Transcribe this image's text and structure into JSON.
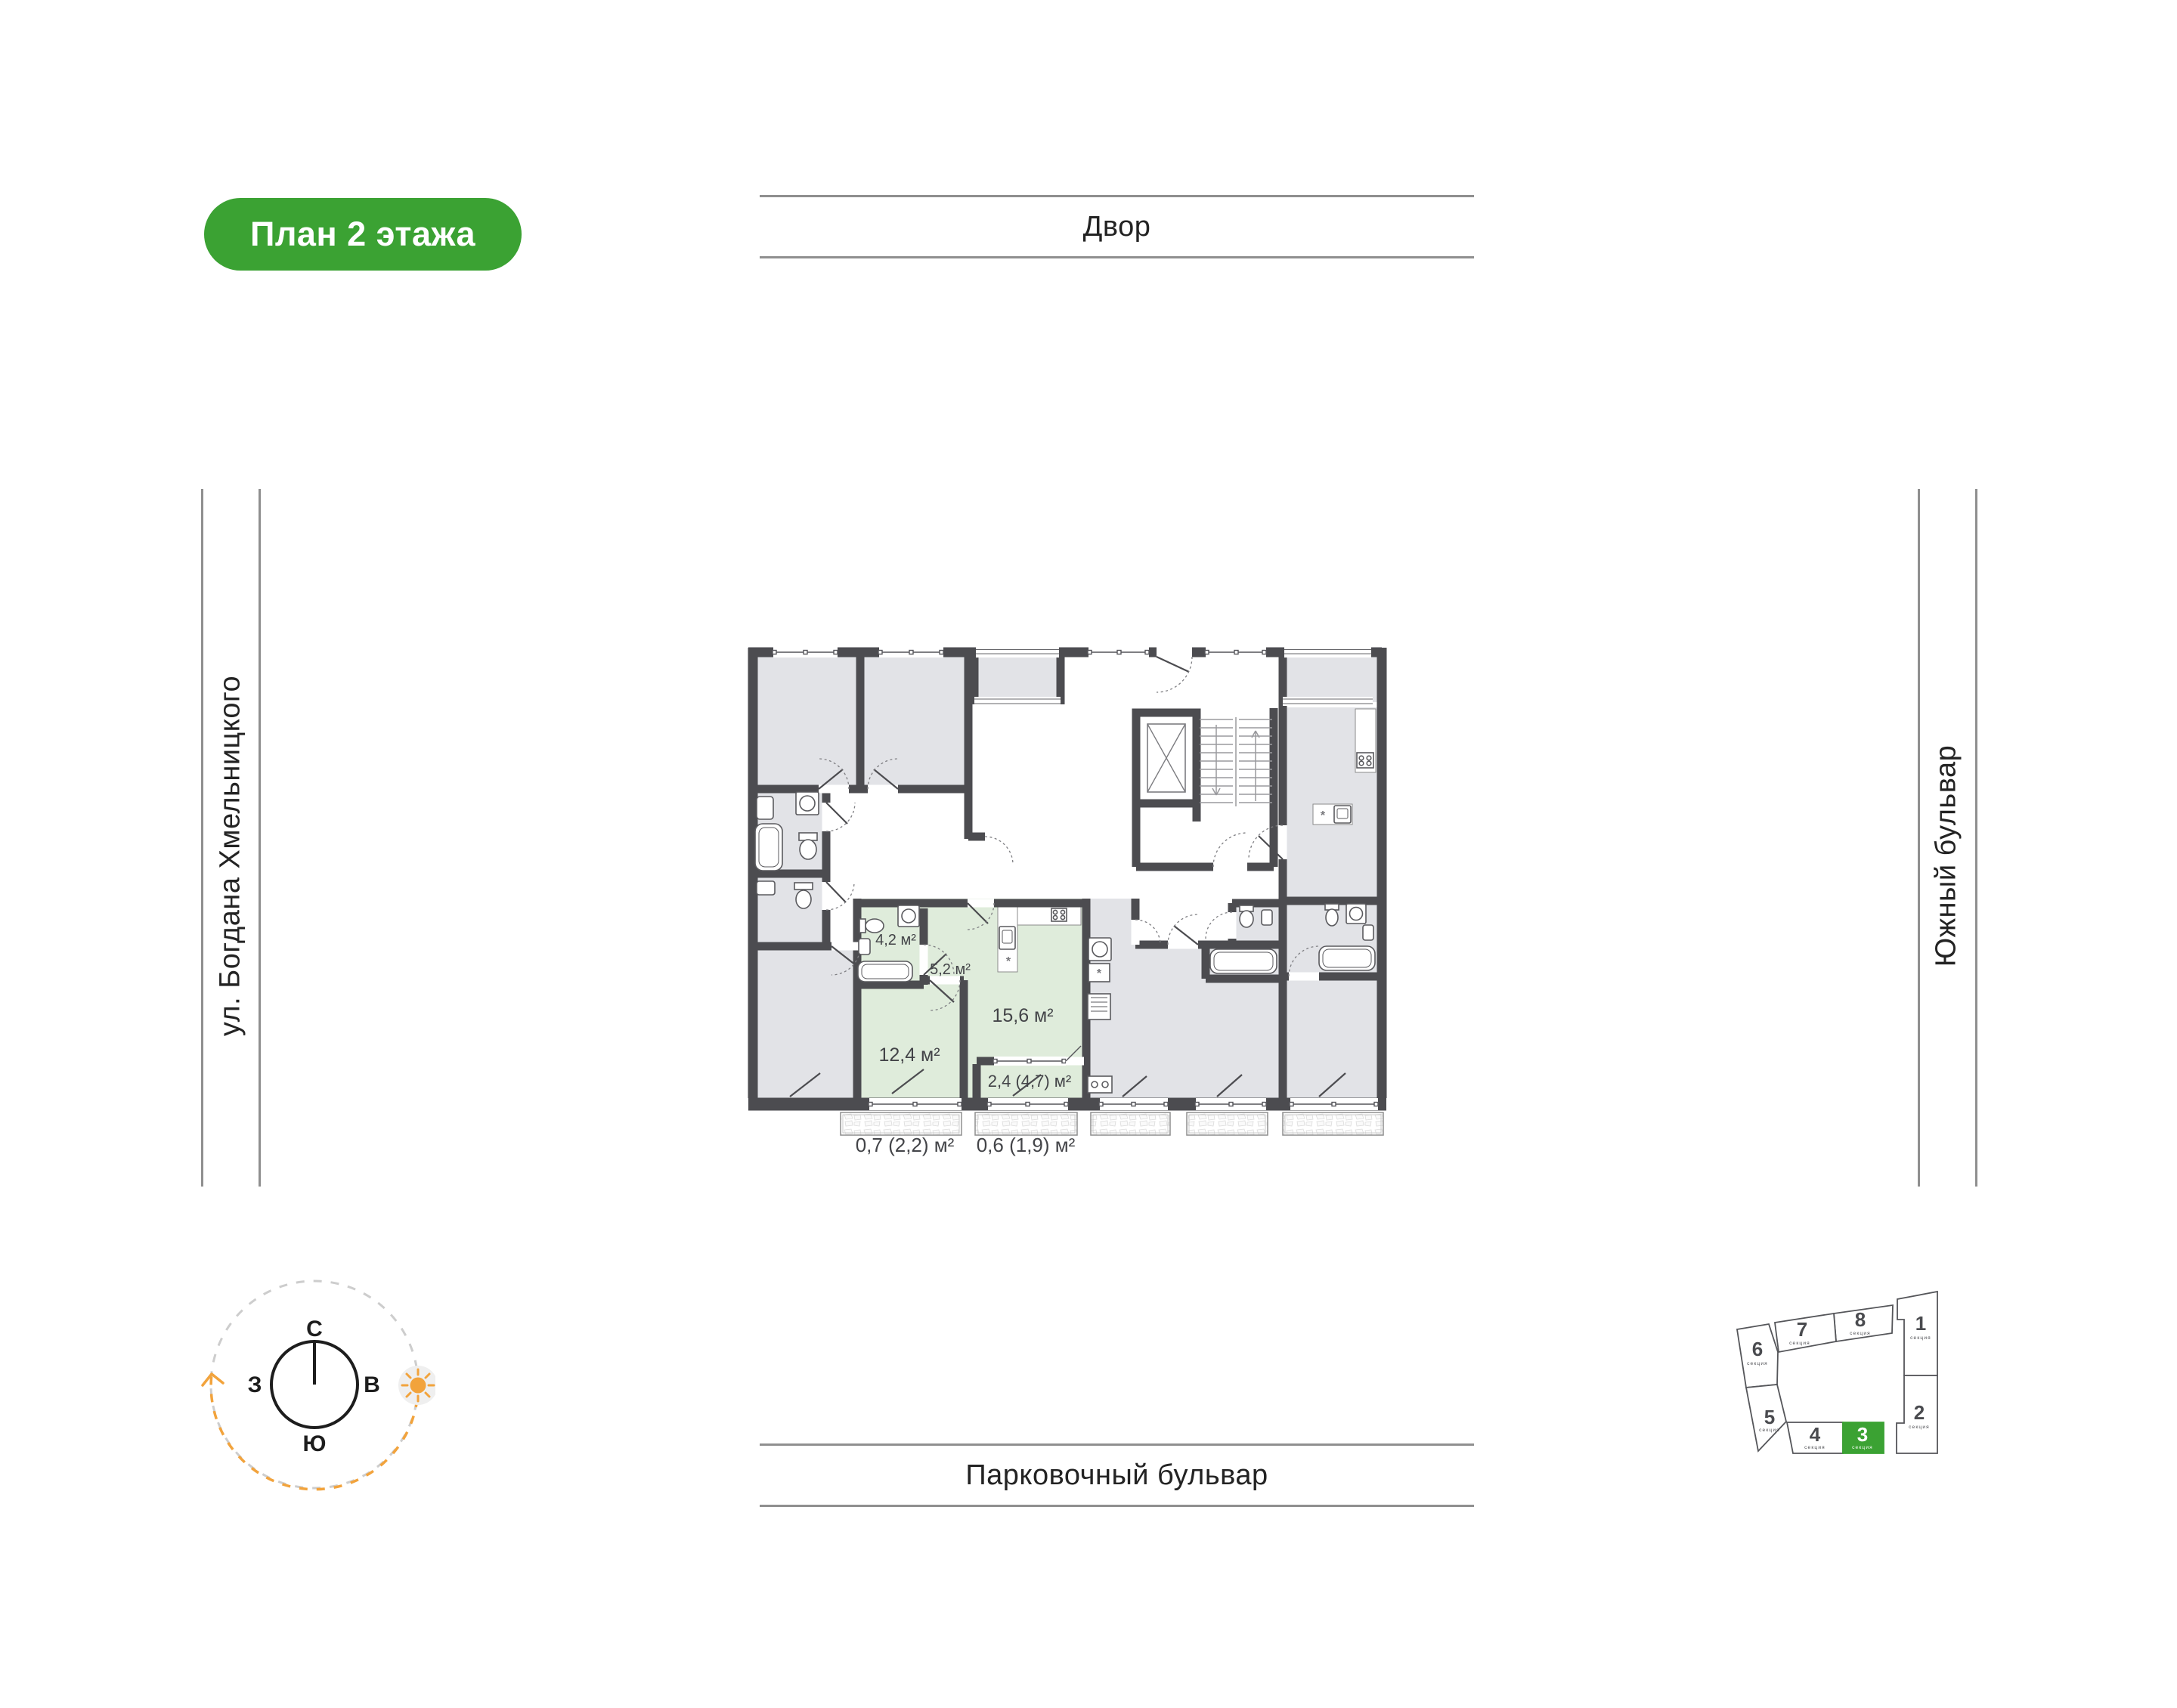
{
  "badge": {
    "label": "План 2 этажа"
  },
  "streets": {
    "top": "Двор",
    "bottom": "Парковочный бульвар",
    "left": "ул. Богдана Хмельницкого",
    "right": "Южный бульвар"
  },
  "plan": {
    "room_labels": [
      {
        "id": "bathroom",
        "label": "4,2 м²"
      },
      {
        "id": "hallway",
        "label": "5,2 м²"
      },
      {
        "id": "kitchen-living",
        "label": "15,6 м²"
      },
      {
        "id": "bedroom",
        "label": "12,4 м²"
      },
      {
        "id": "loggia",
        "label": "2,4 (4,7) м²"
      }
    ],
    "external_balcony_labels": [
      {
        "label": "0,7 (2,2) м²"
      },
      {
        "label": "0,6 (1,9) м²"
      }
    ]
  },
  "compass": {
    "north": "С",
    "east": "В",
    "south": "Ю",
    "west": "З"
  },
  "site_map": {
    "selected_section": "3",
    "sections": [
      {
        "num": "1",
        "label": "секция"
      },
      {
        "num": "2",
        "label": "секция"
      },
      {
        "num": "3",
        "label": "секция"
      },
      {
        "num": "4",
        "label": "секция"
      },
      {
        "num": "5",
        "label": "секция"
      },
      {
        "num": "6",
        "label": "секция"
      },
      {
        "num": "7",
        "label": "секция"
      },
      {
        "num": "8",
        "label": "секция"
      }
    ]
  },
  "colors": {
    "accent_green": "#3BA233",
    "plan_green": "#DFECDB",
    "plan_gray": "#E2E3E7",
    "wall": "#4C4C50",
    "sun_orange": "#F2A33C",
    "street_line_gray": "#8F8F8F"
  }
}
